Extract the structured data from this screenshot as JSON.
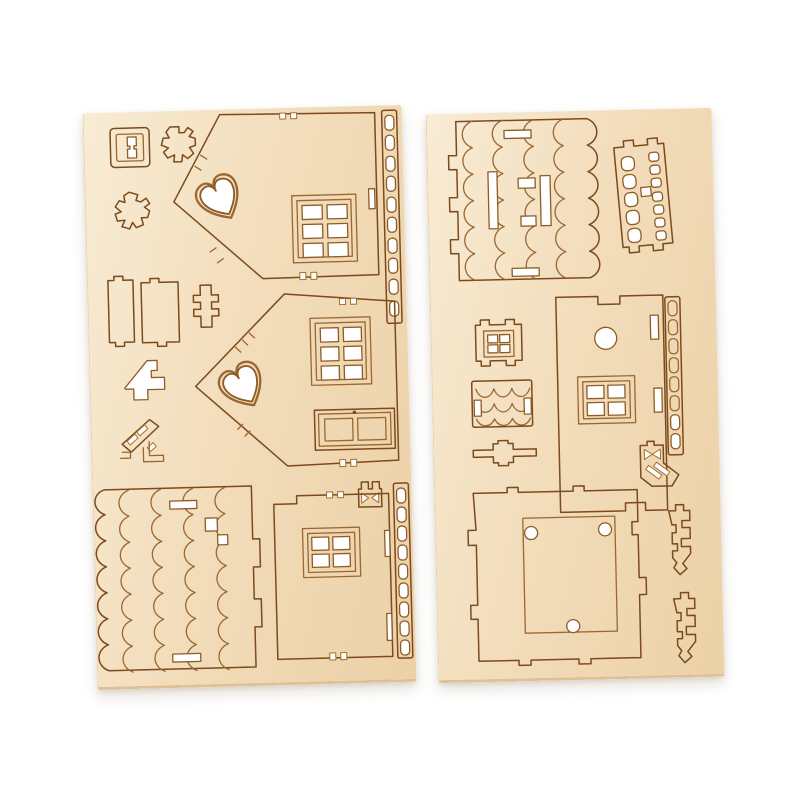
{
  "scene": {
    "type": "product-photo",
    "subject": "Two laser-cut plywood sheets of a DIY miniature wooden house kit, unpunched parts still in the boards",
    "background_color": "#ffffff",
    "text_content": "none"
  },
  "palette": {
    "wood_hi": "#f8ecd4",
    "wood": "#f2dcba",
    "wood_lo": "#ecd1a7",
    "wood_edge": "#dfc094",
    "cut_line": "#9a6732",
    "burn_dark": "#7c4a1c",
    "cutout": "#ffffff"
  },
  "sheets": [
    {
      "aria": "Plywood sheet 1: two gable wall panels with heart cutouts and six-pane windows, a double door, a scalloped shingle roof panel, a lower wall with four-pane window, two ladder strips, connector blocks, chimney and stair scrap pieces",
      "pieces": [
        {
          "label": "small square window frame with spool cutout"
        },
        {
          "label": "jagged snowflake bracket piece A"
        },
        {
          "label": "jagged snowflake bracket piece B"
        },
        {
          "label": "gable wall panel 1 with heart cutout and six-pane window"
        },
        {
          "label": "perforated ladder strip 1"
        },
        {
          "label": "connector block 1"
        },
        {
          "label": "connector block 2"
        },
        {
          "label": "plus-shaped connector"
        },
        {
          "label": "chimney scrap cutout"
        },
        {
          "label": "stair rail piece with slats"
        },
        {
          "label": "gable wall panel 2 with heart cutout, six-pane window and double door"
        },
        {
          "label": "tiny bowtie latch piece"
        },
        {
          "label": "scalloped shingle roof panel with slots"
        },
        {
          "label": "lower wall panel with four-pane window"
        },
        {
          "label": "perforated ladder strip 2"
        }
      ],
      "features": {
        "hearts": 2,
        "six_pane_windows": 2,
        "four_pane_windows": 1,
        "doors": 1
      }
    },
    {
      "aria": "Plywood sheet 2: scalloped shingle roof panel, stair railing with balusters, small four-pane window, small scalloped trim, wall panel with round hole and four-pane window, ladder strip, hatched corner piece, castellated base plate with three round holes, and two zigzag trim pieces",
      "pieces": [
        {
          "label": "scalloped shingle roof panel with slots"
        },
        {
          "label": "stair railing with balusters and ladder slots"
        },
        {
          "label": "small four-pane window frame"
        },
        {
          "label": "small scalloped trim block"
        },
        {
          "label": "cross-bar connector"
        },
        {
          "label": "wall panel with round hole and four-pane window"
        },
        {
          "label": "perforated ladder strip"
        },
        {
          "label": "hatched corner piece with bowtie cutout"
        },
        {
          "label": "castellated base plate with three round holes"
        },
        {
          "label": "zigzag trim piece A"
        },
        {
          "label": "zigzag trim piece B"
        }
      ],
      "features": {
        "round_holes": 4,
        "four_pane_windows": 2
      }
    }
  ]
}
